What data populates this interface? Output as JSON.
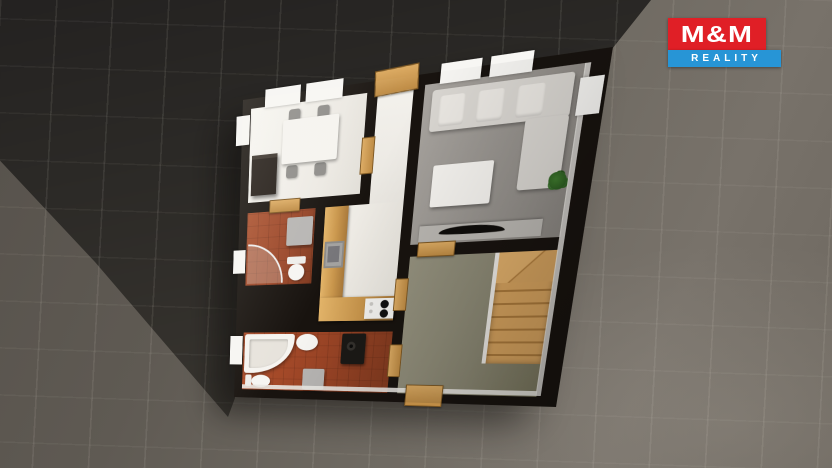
{
  "brand": {
    "name": "M&M",
    "tagline": "REALITY",
    "red": "#e01f26",
    "blue": "#2795d6"
  },
  "scene": {
    "type": "3d-floorplan-render",
    "view": "top-down",
    "background": {
      "tile_color": "#6f6a62",
      "shadow_color": "#2b2926",
      "wall_color": "#18130f"
    }
  },
  "floorplan": {
    "rooms": [
      {
        "id": "dining-room",
        "floor_color": "#efece7",
        "furniture": [
          "dining-table",
          "four-chairs",
          "dark-cabinet",
          "windows"
        ]
      },
      {
        "id": "hallway",
        "floor_color": "#efece7",
        "furniture": [
          "balcony-door"
        ]
      },
      {
        "id": "living-room",
        "floor_color": "#97938e",
        "furniture": [
          "corner-sofa",
          "coffee-table",
          "plant",
          "tv-sideboard",
          "windows"
        ]
      },
      {
        "id": "shower-bathroom",
        "floor_color": "#9a4628",
        "furniture": [
          "corner-shower",
          "toilet",
          "cabinet"
        ]
      },
      {
        "id": "kitchen",
        "floor_color": "#efece7",
        "furniture": [
          "l-shaped-counter",
          "sink",
          "cooktop"
        ]
      },
      {
        "id": "main-bathroom",
        "floor_color": "#9c4526",
        "furniture": [
          "corner-bathtub",
          "round-basin",
          "toilet",
          "cabinet",
          "washing-machine",
          "window"
        ]
      },
      {
        "id": "entry-hall",
        "floor_color": "#8a8773",
        "furniture": [
          "wooden-staircase",
          "entrance-door"
        ]
      }
    ]
  }
}
